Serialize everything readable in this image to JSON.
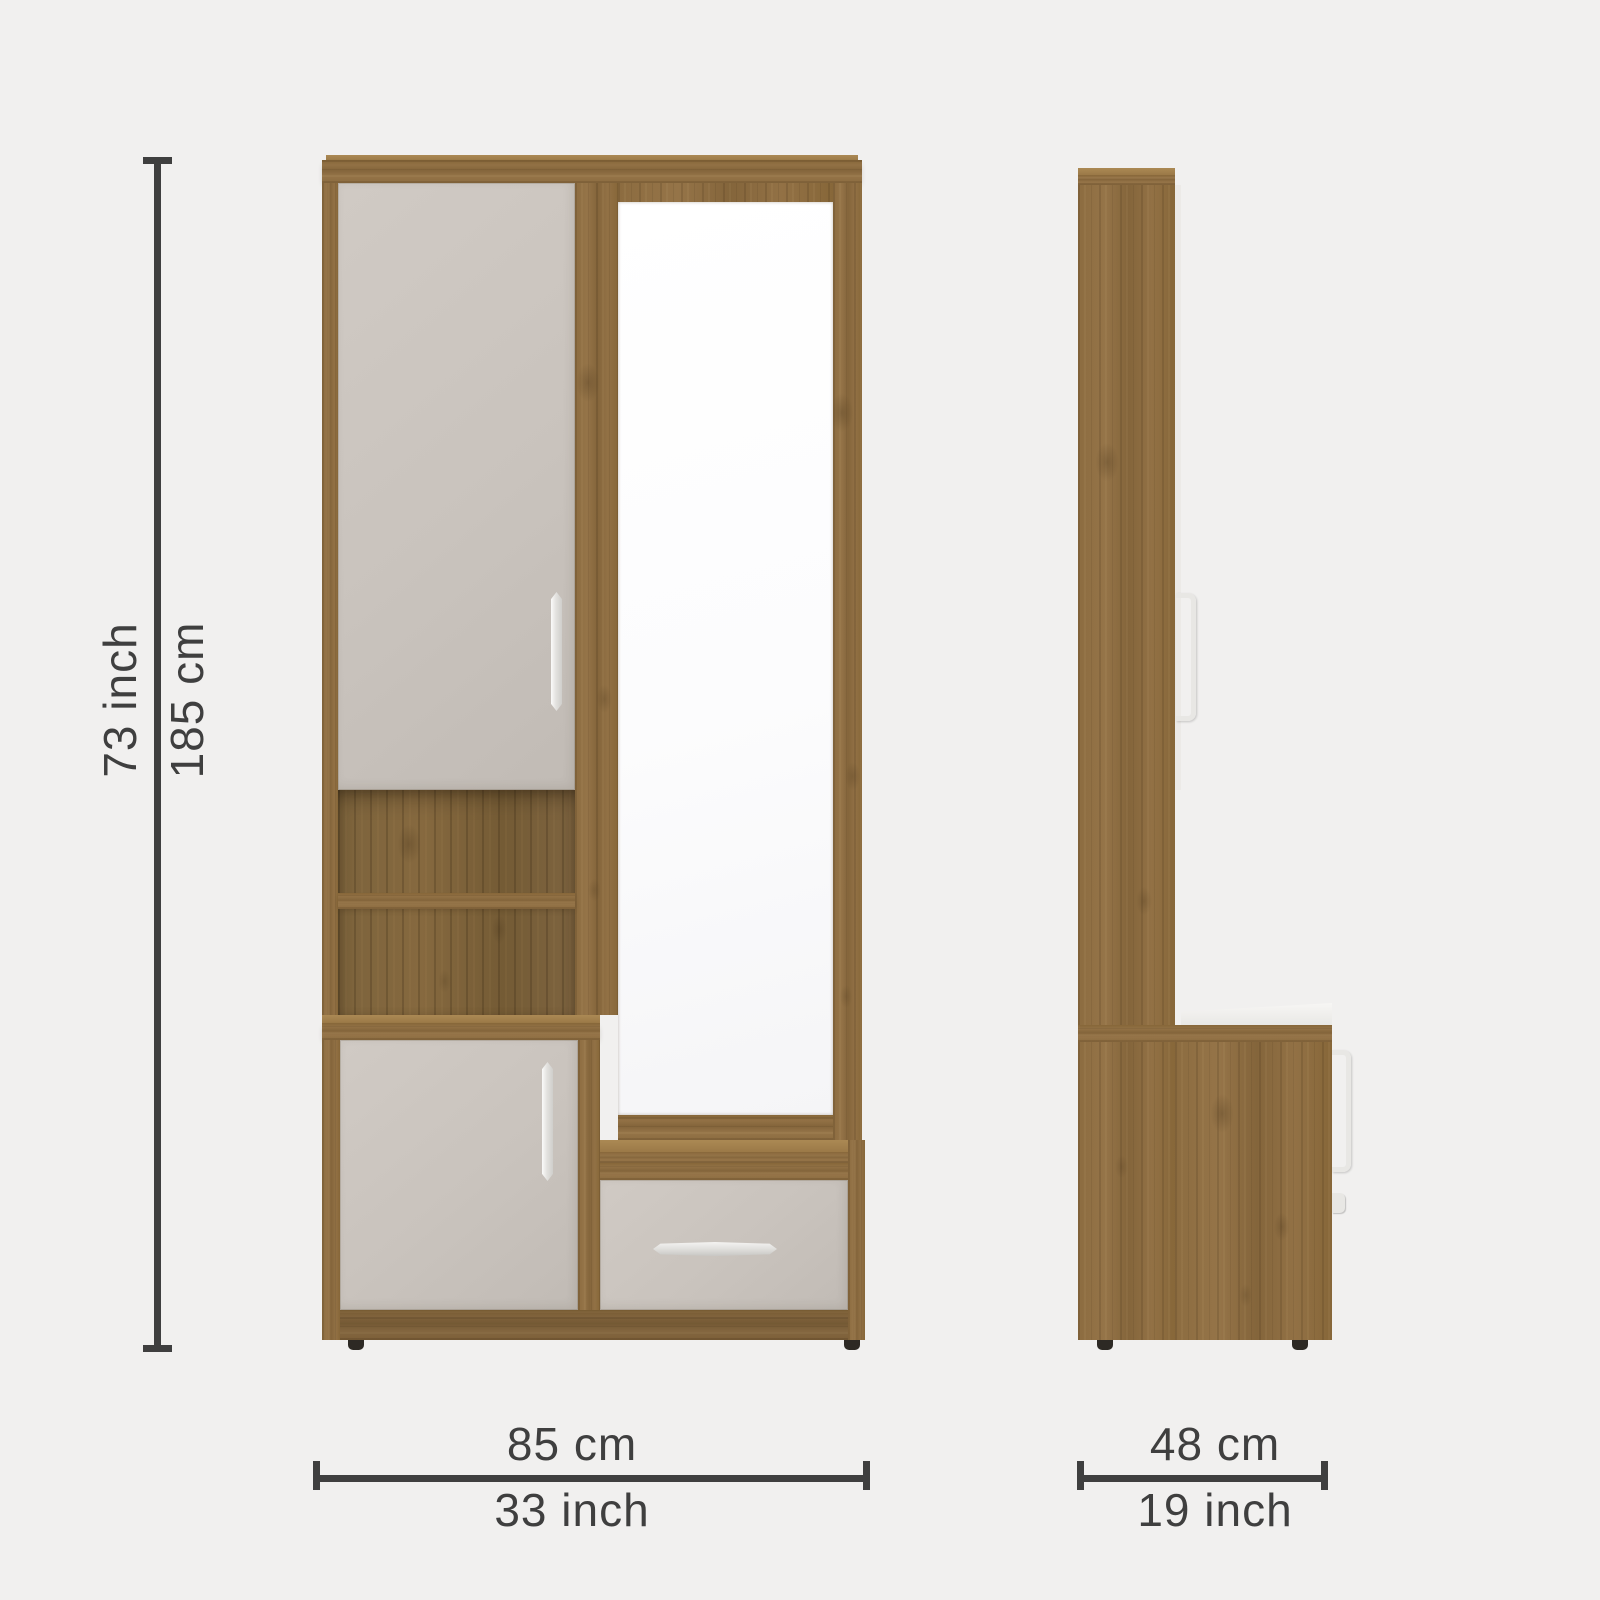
{
  "colors": {
    "bg": "#f1f0ef",
    "ink": "#3f3f3f",
    "wood": "#8a6a3f",
    "wood-dark": "#7b613a",
    "wood-light": "#a5824e",
    "panel": "#c9c3bd",
    "mirror": "#fcfcfd",
    "chrome": "#e8e7e4",
    "feet": "#2d2924"
  },
  "dimensions": {
    "height": {
      "cm": "185 cm",
      "inch": "73 inch"
    },
    "width": {
      "cm": "85 cm",
      "inch": "33 inch"
    },
    "depth": {
      "cm": "48 cm",
      "inch": "19 inch"
    }
  }
}
